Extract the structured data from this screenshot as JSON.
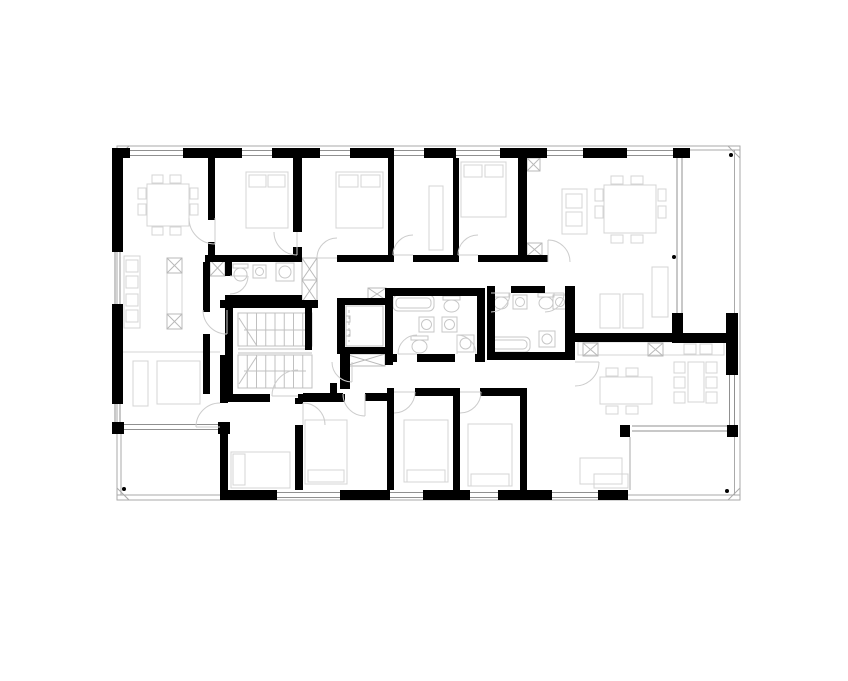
{
  "canvas": {
    "w": 848,
    "h": 681,
    "bg": "#ffffff"
  },
  "palette": {
    "wall": "#000000",
    "outline": "#aaaaaa",
    "window": "#909090",
    "furniture": "#d4d4d4",
    "fixture": "#c7c7c7",
    "door": "#cccccc",
    "hatch": "#b9b9b9",
    "stair": "#c0c0c0",
    "dot": "#000000"
  },
  "outline": {
    "x": 117,
    "y": 146,
    "w": 623,
    "h": 354,
    "miters": [
      [
        117,
        158,
        129,
        146
      ],
      [
        728,
        146,
        740,
        158
      ],
      [
        117,
        488,
        129,
        500
      ],
      [
        740,
        488,
        728,
        500
      ]
    ]
  },
  "rails": [
    [
      734.5,
      150,
      734.5,
      333
    ],
    [
      683,
      150,
      740,
      150
    ],
    [
      734.5,
      430,
      734.5,
      495
    ],
    [
      628,
      495,
      740,
      495
    ],
    [
      121,
      432,
      121,
      495
    ],
    [
      117,
      495,
      222,
      495
    ],
    [
      222,
      432,
      222,
      490
    ],
    [
      630,
      437,
      630,
      490
    ]
  ],
  "walls": [
    [
      112,
      148,
      18,
      10
    ],
    [
      183,
      148,
      59,
      10
    ],
    [
      272,
      148,
      48,
      10
    ],
    [
      350,
      148,
      44,
      10
    ],
    [
      424,
      148,
      32,
      10
    ],
    [
      500,
      148,
      47,
      10
    ],
    [
      583,
      148,
      44,
      10
    ],
    [
      673,
      148,
      17,
      10
    ],
    [
      112,
      158,
      11,
      94
    ],
    [
      112,
      304,
      11,
      100
    ],
    [
      112,
      422,
      12,
      12
    ],
    [
      222,
      490,
      55,
      10
    ],
    [
      340,
      490,
      50,
      10
    ],
    [
      423,
      490,
      47,
      10
    ],
    [
      498,
      490,
      54,
      10
    ],
    [
      598,
      490,
      30,
      10
    ],
    [
      218,
      422,
      12,
      12
    ],
    [
      620,
      425,
      10,
      12
    ],
    [
      727,
      425,
      11,
      12
    ],
    [
      726,
      313,
      12,
      62
    ],
    [
      672,
      313,
      11,
      22
    ],
    [
      672,
      333,
      62,
      10
    ],
    [
      575,
      333,
      100,
      9
    ],
    [
      208,
      158,
      7,
      62
    ],
    [
      208,
      242,
      7,
      13
    ],
    [
      293,
      158,
      9,
      74
    ],
    [
      293,
      247,
      9,
      15
    ],
    [
      388,
      158,
      6,
      104
    ],
    [
      453,
      158,
      6,
      104
    ],
    [
      518,
      158,
      9,
      104
    ],
    [
      205,
      255,
      97,
      7
    ],
    [
      337,
      255,
      56,
      7
    ],
    [
      413,
      255,
      45,
      7
    ],
    [
      478,
      255,
      70,
      7
    ],
    [
      225,
      262,
      7,
      14
    ],
    [
      225,
      295,
      77,
      7
    ],
    [
      203,
      262,
      7,
      50
    ],
    [
      203,
      334,
      7,
      60
    ],
    [
      220,
      300,
      98,
      8
    ],
    [
      225,
      308,
      8,
      94
    ],
    [
      225,
      394,
      45,
      8
    ],
    [
      298,
      394,
      47,
      8
    ],
    [
      305,
      300,
      7,
      50
    ],
    [
      337,
      298,
      8,
      56
    ],
    [
      337,
      298,
      53,
      7
    ],
    [
      337,
      347,
      53,
      7
    ],
    [
      340,
      347,
      10,
      42
    ],
    [
      330,
      383,
      7,
      15
    ],
    [
      303,
      393,
      40,
      8
    ],
    [
      365,
      393,
      22,
      8
    ],
    [
      415,
      388,
      38,
      8
    ],
    [
      480,
      388,
      40,
      8
    ],
    [
      387,
      388,
      7,
      102
    ],
    [
      453,
      388,
      7,
      102
    ],
    [
      520,
      388,
      7,
      102
    ],
    [
      220,
      355,
      8,
      48
    ],
    [
      220,
      425,
      8,
      75
    ],
    [
      295,
      398,
      8,
      6
    ],
    [
      295,
      425,
      8,
      65
    ],
    [
      385,
      288,
      100,
      8
    ],
    [
      385,
      288,
      8,
      77
    ],
    [
      385,
      354,
      12,
      8
    ],
    [
      417,
      354,
      38,
      8
    ],
    [
      475,
      354,
      10,
      8
    ],
    [
      477,
      288,
      8,
      74
    ],
    [
      487,
      286,
      4,
      7
    ],
    [
      511,
      286,
      34,
      7
    ],
    [
      565,
      286,
      10,
      7
    ],
    [
      487,
      286,
      8,
      74
    ],
    [
      487,
      352,
      88,
      8
    ],
    [
      565,
      286,
      10,
      74
    ]
  ],
  "windows": [
    {
      "o": "h",
      "c": 153,
      "a": 130,
      "b": 183
    },
    {
      "o": "h",
      "c": 153,
      "a": 242,
      "b": 272
    },
    {
      "o": "h",
      "c": 153,
      "a": 320,
      "b": 350
    },
    {
      "o": "h",
      "c": 153,
      "a": 394,
      "b": 424
    },
    {
      "o": "h",
      "c": 153,
      "a": 456,
      "b": 500
    },
    {
      "o": "h",
      "c": 153,
      "a": 547,
      "b": 583
    },
    {
      "o": "h",
      "c": 153,
      "a": 627,
      "b": 673
    },
    {
      "o": "v",
      "c": 117.5,
      "a": 252,
      "b": 304
    },
    {
      "o": "v",
      "c": 117.5,
      "a": 404,
      "b": 422
    },
    {
      "o": "h",
      "c": 495,
      "a": 277,
      "b": 340
    },
    {
      "o": "h",
      "c": 495,
      "a": 390,
      "b": 423
    },
    {
      "o": "h",
      "c": 495,
      "a": 470,
      "b": 498
    },
    {
      "o": "h",
      "c": 495,
      "a": 552,
      "b": 598
    },
    {
      "o": "v",
      "c": 732,
      "a": 375,
      "b": 425
    },
    {
      "o": "v",
      "c": 679.5,
      "a": 158,
      "b": 313
    },
    {
      "o": "h",
      "c": 427,
      "a": 124,
      "b": 218
    },
    {
      "o": "h",
      "c": 428.5,
      "a": 632,
      "b": 727
    }
  ],
  "lines": [
    [
      123,
      352,
      220,
      352
    ]
  ],
  "furniture": [
    {
      "n": "kitchen-counter",
      "r": [
        124,
        256,
        16,
        72
      ]
    },
    {
      "n": "kitchen-appliance",
      "r": [
        126,
        260,
        12,
        12
      ]
    },
    {
      "n": "kitchen-appliance",
      "r": [
        126,
        276,
        12,
        12
      ]
    },
    {
      "n": "kitchen-appliance",
      "r": [
        126,
        294,
        12,
        12
      ]
    },
    {
      "n": "kitchen-appliance",
      "r": [
        126,
        310,
        12,
        12
      ]
    },
    {
      "n": "kitchen-island",
      "r": [
        167,
        258,
        15,
        71
      ]
    },
    {
      "n": "dining-table",
      "r": [
        147,
        184,
        42,
        42
      ]
    },
    {
      "n": "chair",
      "r": [
        138,
        188,
        8,
        11
      ]
    },
    {
      "n": "chair",
      "r": [
        138,
        204,
        8,
        11
      ]
    },
    {
      "n": "chair",
      "r": [
        190,
        188,
        8,
        11
      ]
    },
    {
      "n": "chair",
      "r": [
        190,
        204,
        8,
        11
      ]
    },
    {
      "n": "chair",
      "r": [
        152,
        175,
        11,
        8
      ]
    },
    {
      "n": "chair",
      "r": [
        170,
        175,
        11,
        8
      ]
    },
    {
      "n": "chair",
      "r": [
        152,
        227,
        11,
        8
      ]
    },
    {
      "n": "chair",
      "r": [
        170,
        227,
        11,
        8
      ]
    },
    {
      "n": "bed",
      "r": [
        246,
        172,
        42,
        56
      ]
    },
    {
      "n": "pillow",
      "r": [
        249,
        175,
        17,
        12
      ]
    },
    {
      "n": "pillow",
      "r": [
        268,
        175,
        17,
        12
      ]
    },
    {
      "n": "bed",
      "r": [
        336,
        172,
        47,
        56
      ]
    },
    {
      "n": "pillow",
      "r": [
        339,
        175,
        19,
        12
      ]
    },
    {
      "n": "pillow",
      "r": [
        361,
        175,
        19,
        12
      ]
    },
    {
      "n": "wardrobe",
      "r": [
        429,
        186,
        14,
        64
      ]
    },
    {
      "n": "bed",
      "r": [
        461,
        162,
        45,
        55
      ]
    },
    {
      "n": "pillow",
      "r": [
        464,
        165,
        18,
        12
      ]
    },
    {
      "n": "pillow",
      "r": [
        485,
        165,
        18,
        12
      ]
    },
    {
      "n": "kitchen-island",
      "r": [
        562,
        189,
        25,
        45
      ]
    },
    {
      "n": "kitchen-appliance",
      "r": [
        566,
        194,
        16,
        14
      ]
    },
    {
      "n": "kitchen-appliance",
      "r": [
        566,
        212,
        16,
        14
      ]
    },
    {
      "n": "dining-table",
      "r": [
        604,
        185,
        52,
        48
      ]
    },
    {
      "n": "chair",
      "r": [
        595,
        189,
        8,
        12
      ]
    },
    {
      "n": "chair",
      "r": [
        595,
        206,
        8,
        12
      ]
    },
    {
      "n": "chair",
      "r": [
        658,
        189,
        8,
        12
      ]
    },
    {
      "n": "chair",
      "r": [
        658,
        206,
        8,
        12
      ]
    },
    {
      "n": "chair",
      "r": [
        611,
        176,
        12,
        8
      ]
    },
    {
      "n": "chair",
      "r": [
        631,
        176,
        12,
        8
      ]
    },
    {
      "n": "chair",
      "r": [
        611,
        235,
        12,
        8
      ]
    },
    {
      "n": "chair",
      "r": [
        631,
        235,
        12,
        8
      ]
    },
    {
      "n": "sideboard",
      "r": [
        652,
        267,
        16,
        50
      ]
    },
    {
      "n": "lounge-chair",
      "r": [
        600,
        294,
        20,
        34
      ]
    },
    {
      "n": "lounge-chair",
      "r": [
        623,
        294,
        20,
        34
      ]
    },
    {
      "n": "kitchen-counter",
      "r": [
        578,
        342,
        146,
        13
      ]
    },
    {
      "n": "kitchen-appliance",
      "r": [
        700,
        344,
        12,
        10
      ]
    },
    {
      "n": "kitchen-appliance",
      "r": [
        684,
        344,
        12,
        10
      ]
    },
    {
      "n": "dining-table",
      "r": [
        600,
        377,
        52,
        27
      ]
    },
    {
      "n": "chair",
      "r": [
        606,
        368,
        12,
        8
      ]
    },
    {
      "n": "chair",
      "r": [
        626,
        368,
        12,
        8
      ]
    },
    {
      "n": "chair",
      "r": [
        606,
        406,
        12,
        8
      ]
    },
    {
      "n": "chair",
      "r": [
        626,
        406,
        12,
        8
      ]
    },
    {
      "n": "dining-table",
      "r": [
        688,
        362,
        16,
        40
      ]
    },
    {
      "n": "chair",
      "r": [
        674,
        362,
        11,
        11
      ]
    },
    {
      "n": "chair",
      "r": [
        674,
        377,
        11,
        11
      ]
    },
    {
      "n": "chair",
      "r": [
        674,
        392,
        11,
        11
      ]
    },
    {
      "n": "chair",
      "r": [
        706,
        362,
        11,
        11
      ]
    },
    {
      "n": "chair",
      "r": [
        706,
        377,
        11,
        11
      ]
    },
    {
      "n": "chair",
      "r": [
        706,
        392,
        11,
        11
      ]
    },
    {
      "n": "sofa",
      "r": [
        580,
        458,
        42,
        26
      ]
    },
    {
      "n": "sideboard",
      "r": [
        594,
        474,
        34,
        14
      ]
    },
    {
      "n": "armchair",
      "r": [
        133,
        361,
        15,
        45
      ]
    },
    {
      "n": "side-table",
      "r": [
        157,
        361,
        43,
        43
      ]
    },
    {
      "n": "bed",
      "r": [
        231,
        452,
        59,
        36
      ]
    },
    {
      "n": "pillow",
      "r": [
        233,
        454,
        12,
        31
      ]
    },
    {
      "n": "bed",
      "r": [
        305,
        420,
        42,
        64
      ]
    },
    {
      "n": "pillow",
      "r": [
        308,
        470,
        36,
        12
      ]
    },
    {
      "n": "bed",
      "r": [
        404,
        420,
        44,
        62
      ]
    },
    {
      "n": "pillow",
      "r": [
        407,
        470,
        38,
        12
      ]
    },
    {
      "n": "bed",
      "r": [
        468,
        424,
        44,
        62
      ]
    },
    {
      "n": "pillow",
      "r": [
        471,
        474,
        38,
        12
      ]
    }
  ],
  "fixtures": [
    {
      "k": "toilet",
      "n": "toilet",
      "r": [
        233,
        264,
        15,
        17
      ]
    },
    {
      "k": "sink",
      "n": "sink",
      "r": [
        253,
        265,
        13,
        13
      ]
    },
    {
      "k": "washer",
      "n": "washing-machine",
      "r": [
        276,
        263,
        18,
        18
      ]
    },
    {
      "k": "tub",
      "n": "bathtub",
      "r": [
        393,
        295,
        41,
        16
      ]
    },
    {
      "k": "sink",
      "n": "sink",
      "r": [
        419,
        317,
        15,
        15
      ]
    },
    {
      "k": "toilet",
      "n": "toilet",
      "r": [
        411,
        336,
        17,
        17
      ]
    },
    {
      "k": "toilet",
      "n": "toilet",
      "r": [
        443,
        296,
        17,
        16
      ]
    },
    {
      "k": "sink",
      "n": "sink",
      "r": [
        442,
        317,
        15,
        15
      ]
    },
    {
      "k": "washer",
      "n": "washing-machine",
      "r": [
        457,
        335,
        17,
        17
      ]
    },
    {
      "k": "toilet",
      "n": "toilet",
      "r": [
        493,
        293,
        16,
        16
      ]
    },
    {
      "k": "sink",
      "n": "sink",
      "r": [
        513,
        295,
        14,
        14
      ]
    },
    {
      "k": "tub",
      "n": "bathtub",
      "r": [
        489,
        337,
        41,
        15
      ]
    },
    {
      "k": "toilet",
      "n": "toilet",
      "r": [
        538,
        293,
        16,
        16
      ]
    },
    {
      "k": "sink",
      "n": "sink",
      "r": [
        553,
        295,
        14,
        14
      ]
    },
    {
      "k": "washer",
      "n": "washing-machine",
      "r": [
        539,
        331,
        16,
        16
      ]
    }
  ],
  "stairs": {
    "flights": [
      [
        238,
        313,
        74,
        33
      ],
      [
        238,
        355,
        74,
        33
      ]
    ],
    "treads": 8,
    "lines": [
      [
        238,
        349,
        312,
        349
      ],
      [
        238,
        353,
        312,
        353
      ],
      [
        239,
        318,
        257,
        346
      ],
      [
        239,
        384,
        257,
        356
      ],
      [
        244,
        330,
        306,
        330
      ],
      [
        244,
        371,
        306,
        371
      ]
    ]
  },
  "elevator": {
    "r": [
      346,
      306,
      37,
      40
    ],
    "door": [
      349,
      310,
      349,
      342
    ],
    "ticks": [
      [
        346,
        316,
        4,
        6
      ],
      [
        346,
        330,
        4,
        6
      ]
    ]
  },
  "hatches": [
    [
      302,
      258,
      15,
      22
    ],
    [
      302,
      280,
      15,
      22
    ],
    [
      210,
      260,
      15,
      16
    ],
    [
      368,
      288,
      18,
      12
    ],
    [
      345,
      354,
      40,
      12
    ],
    [
      527,
      158,
      13,
      13
    ],
    [
      527,
      243,
      15,
      13
    ],
    [
      583,
      343,
      15,
      13
    ],
    [
      648,
      343,
      15,
      13
    ],
    [
      167,
      258,
      15,
      15
    ],
    [
      167,
      314,
      15,
      15
    ]
  ],
  "doors": [
    [
      215,
      218,
      26,
      90,
      180
    ],
    [
      297,
      232,
      23,
      90,
      180
    ],
    [
      337,
      258,
      20,
      180,
      270
    ],
    [
      413,
      255,
      20,
      180,
      270
    ],
    [
      478,
      255,
      20,
      180,
      270
    ],
    [
      548,
      262,
      22,
      270,
      360
    ],
    [
      230,
      276,
      18,
      0,
      90
    ],
    [
      227,
      310,
      24,
      90,
      180
    ],
    [
      298,
      396,
      26,
      180,
      270
    ],
    [
      417,
      354,
      19,
      180,
      270
    ],
    [
      457,
      354,
      19,
      270,
      360
    ],
    [
      491,
      293,
      19,
      0,
      90
    ],
    [
      545,
      293,
      19,
      0,
      90
    ],
    [
      365,
      394,
      22,
      90,
      180
    ],
    [
      394,
      392,
      21,
      0,
      90
    ],
    [
      460,
      392,
      21,
      0,
      90
    ],
    [
      575,
      362,
      24,
      0,
      90
    ],
    [
      352,
      362,
      20,
      90,
      180
    ],
    [
      220,
      427,
      24,
      180,
      270
    ],
    [
      303,
      425,
      22,
      270,
      360
    ]
  ],
  "dots": [
    [
      674,
      257
    ],
    [
      731,
      155
    ],
    [
      727,
      491
    ],
    [
      124,
      489
    ]
  ]
}
